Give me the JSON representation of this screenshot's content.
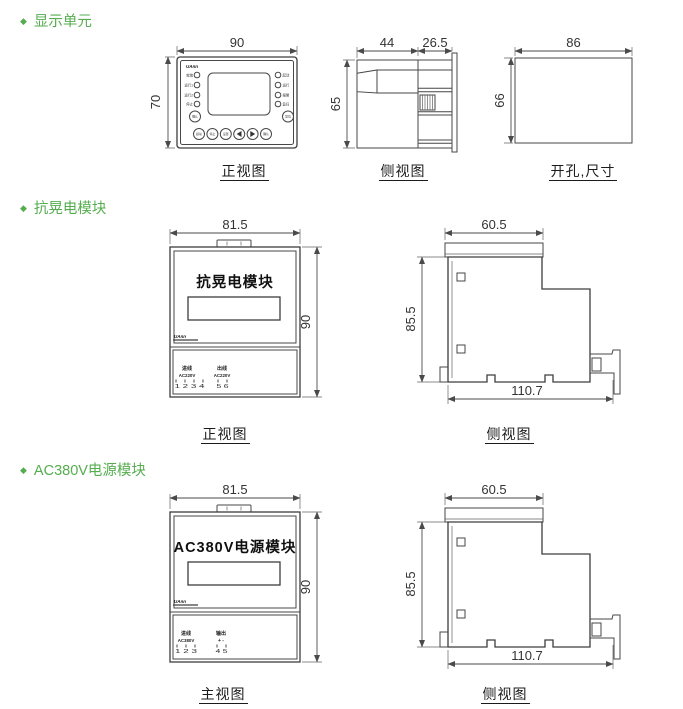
{
  "page": {
    "background": "#ffffff",
    "accent_green": "#56ad4f",
    "line_color": "#474747"
  },
  "sections": {
    "display_unit": {
      "title": "显示单元",
      "front": {
        "caption": "正视图",
        "dim_width": "90",
        "dim_height": "70",
        "logo": "UAnn",
        "left_leds": [
          "就绪",
          "运行1",
          "运行2",
          "停止"
        ],
        "right_leds": [
          "起动",
          "运行",
          "报警",
          "复归"
        ],
        "btn_left": "确认",
        "btn_right": "复位",
        "bottom_buttons": [
          "起动",
          "停止",
          "设置",
          "确认"
        ],
        "icons": [
          "left-arrow-icon",
          "right-arrow-icon"
        ]
      },
      "side": {
        "caption": "侧视图",
        "dim_front": "44",
        "dim_rear": "26.5",
        "dim_height": "65"
      },
      "cutout": {
        "caption": "开孔,尺寸",
        "dim_width": "86",
        "dim_height": "66"
      }
    },
    "sag_module": {
      "title": "抗晃电模块",
      "front": {
        "caption": "正视图",
        "dim_width": "81.5",
        "dim_height": "90",
        "face_label": "抗晃电模块",
        "logo": "UAnn",
        "term_in_label": "进线",
        "term_in_voltage": "AC220V",
        "term_in_pins": "1 2 3 4",
        "term_out_label": "出线",
        "term_out_voltage": "AC220V",
        "term_out_pins": "5 6"
      },
      "side": {
        "caption": "侧视图",
        "dim_top": "60.5",
        "dim_height": "85.5",
        "dim_bottom": "110.7"
      }
    },
    "power_module": {
      "title": "AC380V电源模块",
      "front": {
        "caption": "主视图",
        "dim_width": "81.5",
        "dim_height": "90",
        "face_label": "AC380V电源模块",
        "logo": "UAnn",
        "term_in_label": "进线",
        "term_in_voltage": "AC380V",
        "term_in_pins": "1 2 3",
        "term_out_label": "输出",
        "term_out_voltage": "+ -",
        "term_out_pins": "4 5"
      },
      "side": {
        "caption": "侧视图",
        "dim_top": "60.5",
        "dim_height": "85.5",
        "dim_bottom": "110.7"
      }
    }
  }
}
